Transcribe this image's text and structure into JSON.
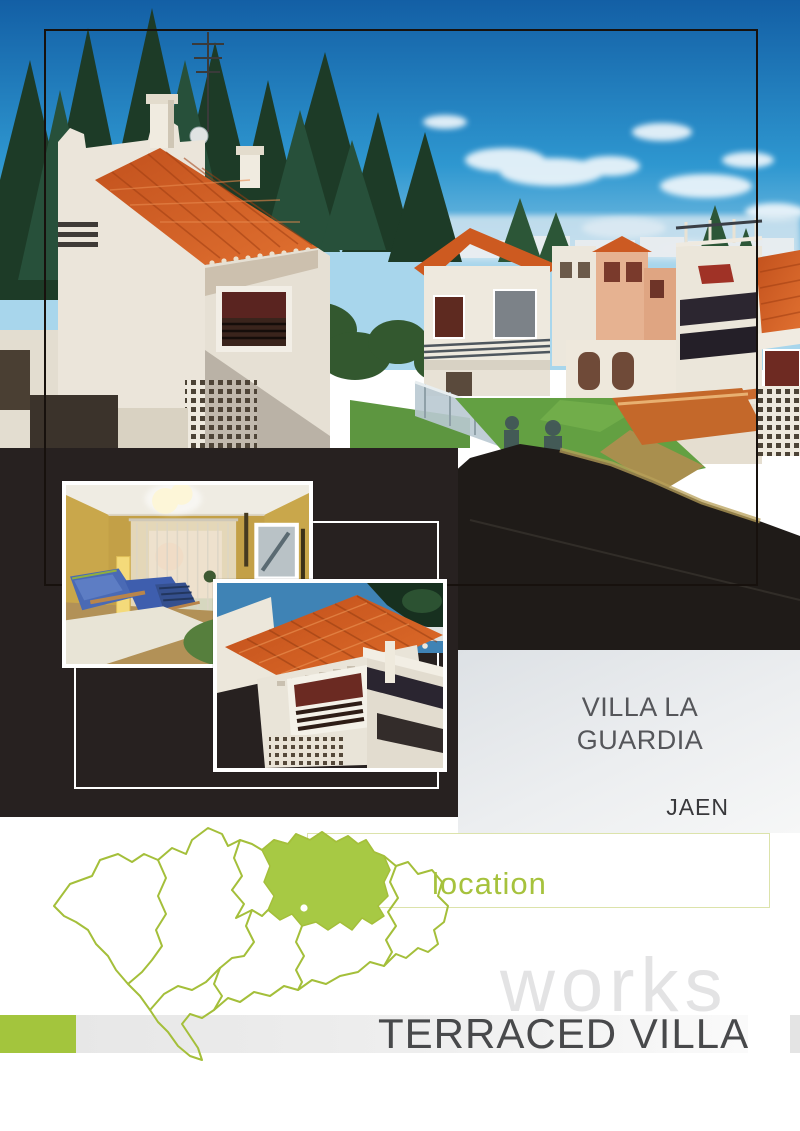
{
  "brochure": {
    "title_line1": "VILLA LA",
    "title_line2": "GUARDIA",
    "province": "JAEN",
    "location_label": "location",
    "watermark": "works",
    "work_type": "TERRACED VILLA"
  },
  "map": {
    "region": "Andalucia provinces outline",
    "highlighted_province": "JAEN"
  },
  "photos": {
    "main": "Aerial view of white terraced villas with orange tiled roofs under a blue sky",
    "interior": "Living room with yellow walls, sheer curtains and blue sofas",
    "detail": "Close-up of villa with orange tiled roof, louvred window and lattice wall"
  },
  "colors": {
    "accent_green": "#a3c53d",
    "map_green": "#a7c944",
    "location_border": "#dce3ab",
    "dark_panel": "#272120",
    "title_text": "#55565a",
    "province_text": "#38383b",
    "watermark_gray": "#e3e3e4",
    "work_type_text": "#48494b"
  }
}
